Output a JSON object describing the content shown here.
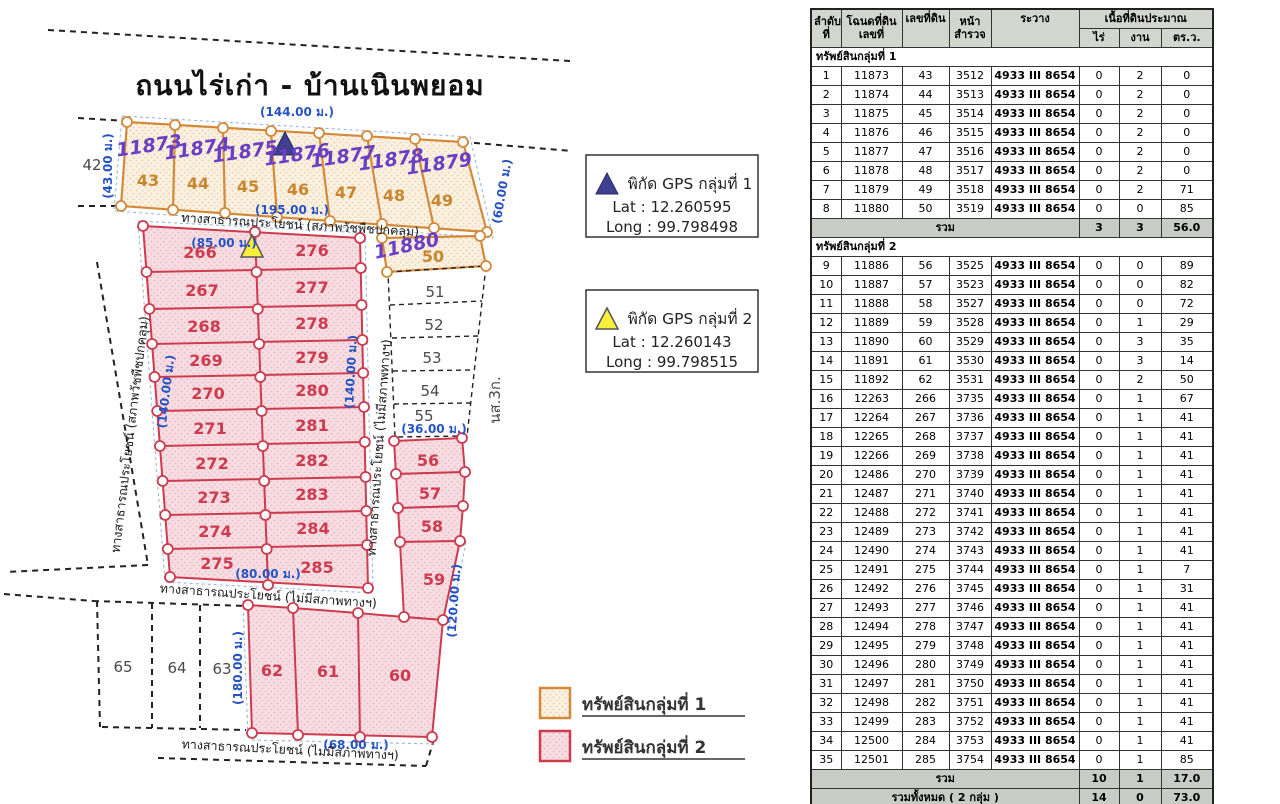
{
  "map": {
    "title": "ถนนไร่เก่า - บ้านเนินพยอม",
    "neighbor_left": "42",
    "ns3k": "นส.3ก.",
    "g1": {
      "deeds": [
        "11873",
        "11874",
        "11875",
        "11876",
        "11877",
        "11878",
        "11879"
      ],
      "nums": [
        "43",
        "44",
        "45",
        "46",
        "47",
        "48",
        "49"
      ],
      "dims": {
        "top": "(144.00 ม.)",
        "left": "(43.00 ม.)",
        "bottom": "(195.00 ม.)",
        "right": "(60.00 ม.)"
      }
    },
    "p50": {
      "deed": "11880",
      "num": "50"
    },
    "white_col": [
      "51",
      "52",
      "53",
      "54",
      "55"
    ],
    "white_col_dim": "(36.00 ม.)",
    "pink": {
      "left": [
        "266",
        "267",
        "268",
        "269",
        "270",
        "271",
        "272",
        "273",
        "274",
        "275"
      ],
      "right": [
        "276",
        "277",
        "278",
        "279",
        "280",
        "281",
        "282",
        "283",
        "284",
        "285"
      ],
      "dims": {
        "top": "(85.00 ม.)",
        "left": "(140.00 ม.)",
        "right": "(140.00 ม.)",
        "bottom": "(80.00 ม.)"
      }
    },
    "side": [
      "56",
      "57",
      "58",
      "59"
    ],
    "side_dim": "(120.00 ม.)",
    "bottom": {
      "nums": [
        "62",
        "61",
        "60"
      ],
      "dim_left": "(180.00 ม.)",
      "dim_bottom": "(68.00 ม.)"
    },
    "bottom_white": [
      "65",
      "64",
      "63"
    ],
    "roads": {
      "r1": "ทางสาธารณประโยชน์ (สภาพวัชพืชปกคลุม)",
      "r2": "ทางสาธารณประโยชน์ (สภาพวัชพืชปกคลุม)",
      "r3": "ทางสาธารณประโยชน์ (ไม่มีสภาพทางฯ)",
      "r4": "ทางสาธารณประโยชน์ (ไม่มีสภาพทางฯ)",
      "r5": "ทางสาธารณประโยชน์ (ไม่มีสภาพทางฯ)"
    },
    "colors": {
      "group1_accent": "#d4893a",
      "group2_accent": "#cc3b4e",
      "dim_blue": "#2653c4",
      "handwriting_purple": "#6b3fc4"
    }
  },
  "gps": {
    "g1": {
      "title": "พิกัด GPS  กลุ่มที่ 1",
      "lat": "Lat : 12.260595",
      "long": "Long : 99.798498",
      "marker": "navy-triangle"
    },
    "g2": {
      "title": "พิกัด GPS  กลุ่มที่ 2",
      "lat": "Lat : 12.260143",
      "long": "Long : 99.798515",
      "marker": "yellow-triangle"
    }
  },
  "legend": {
    "g1": "ทรัพย์สินกลุ่มที่ 1",
    "g2": "ทรัพย์สินกลุ่มที่ 2"
  },
  "table": {
    "headers": {
      "no1": "ลำดับ",
      "no2": "ที่",
      "deed1": "โฉนดที่ดิน",
      "deed2": "เลขที่",
      "land": "เลขที่ดิน",
      "page1": "หน้า",
      "page2": "สำรวจ",
      "sheet": "ระวาง",
      "area": "เนื้อที่ดินประมาณ",
      "rai": "ไร่",
      "ngan": "งาน",
      "wah": "ตร.ว."
    },
    "sections": [
      {
        "title": "ทรัพย์สินกลุ่มที่ 1",
        "rows": [
          [
            "1",
            "11873",
            "43",
            "3512",
            "4933 III 8654",
            "0",
            "2",
            "0"
          ],
          [
            "2",
            "11874",
            "44",
            "3513",
            "4933 III 8654",
            "0",
            "2",
            "0"
          ],
          [
            "3",
            "11875",
            "45",
            "3514",
            "4933 III 8654",
            "0",
            "2",
            "0"
          ],
          [
            "4",
            "11876",
            "46",
            "3515",
            "4933 III 8654",
            "0",
            "2",
            "0"
          ],
          [
            "5",
            "11877",
            "47",
            "3516",
            "4933 III 8654",
            "0",
            "2",
            "0"
          ],
          [
            "6",
            "11878",
            "48",
            "3517",
            "4933 III 8654",
            "0",
            "2",
            "0"
          ],
          [
            "7",
            "11879",
            "49",
            "3518",
            "4933 III 8654",
            "0",
            "2",
            "71"
          ],
          [
            "8",
            "11880",
            "50",
            "3519",
            "4933 III 8654",
            "0",
            "0",
            "85"
          ]
        ],
        "total": {
          "label": "รวม",
          "rai": "3",
          "ngan": "3",
          "wah": "56.0"
        }
      },
      {
        "title": "ทรัพย์สินกลุ่มที่ 2",
        "rows": [
          [
            "9",
            "11886",
            "56",
            "3525",
            "4933 III 8654",
            "0",
            "0",
            "89"
          ],
          [
            "10",
            "11887",
            "57",
            "3523",
            "4933 III 8654",
            "0",
            "0",
            "82"
          ],
          [
            "11",
            "11888",
            "58",
            "3527",
            "4933 III 8654",
            "0",
            "0",
            "72"
          ],
          [
            "12",
            "11889",
            "59",
            "3528",
            "4933 III 8654",
            "0",
            "1",
            "29"
          ],
          [
            "13",
            "11890",
            "60",
            "3529",
            "4933 III 8654",
            "0",
            "3",
            "35"
          ],
          [
            "14",
            "11891",
            "61",
            "3530",
            "4933 III 8654",
            "0",
            "3",
            "14"
          ],
          [
            "15",
            "11892",
            "62",
            "3531",
            "4933 III 8654",
            "0",
            "2",
            "50"
          ],
          [
            "16",
            "12263",
            "266",
            "3735",
            "4933 III 8654",
            "0",
            "1",
            "67"
          ],
          [
            "17",
            "12264",
            "267",
            "3736",
            "4933 III 8654",
            "0",
            "1",
            "41"
          ],
          [
            "18",
            "12265",
            "268",
            "3737",
            "4933 III 8654",
            "0",
            "1",
            "41"
          ],
          [
            "19",
            "12266",
            "269",
            "3738",
            "4933 III 8654",
            "0",
            "1",
            "41"
          ],
          [
            "20",
            "12486",
            "270",
            "3739",
            "4933 III 8654",
            "0",
            "1",
            "41"
          ],
          [
            "21",
            "12487",
            "271",
            "3740",
            "4933 III 8654",
            "0",
            "1",
            "41"
          ],
          [
            "22",
            "12488",
            "272",
            "3741",
            "4933 III 8654",
            "0",
            "1",
            "41"
          ],
          [
            "23",
            "12489",
            "273",
            "3742",
            "4933 III 8654",
            "0",
            "1",
            "41"
          ],
          [
            "24",
            "12490",
            "274",
            "3743",
            "4933 III 8654",
            "0",
            "1",
            "41"
          ],
          [
            "25",
            "12491",
            "275",
            "3744",
            "4933 III 8654",
            "0",
            "1",
            "7"
          ],
          [
            "26",
            "12492",
            "276",
            "3745",
            "4933 III 8654",
            "0",
            "1",
            "31"
          ],
          [
            "27",
            "12493",
            "277",
            "3746",
            "4933 III 8654",
            "0",
            "1",
            "41"
          ],
          [
            "28",
            "12494",
            "278",
            "3747",
            "4933 III 8654",
            "0",
            "1",
            "41"
          ],
          [
            "29",
            "12495",
            "279",
            "3748",
            "4933 III 8654",
            "0",
            "1",
            "41"
          ],
          [
            "30",
            "12496",
            "280",
            "3749",
            "4933 III 8654",
            "0",
            "1",
            "41"
          ],
          [
            "31",
            "12497",
            "281",
            "3750",
            "4933 III 8654",
            "0",
            "1",
            "41"
          ],
          [
            "32",
            "12498",
            "282",
            "3751",
            "4933 III 8654",
            "0",
            "1",
            "41"
          ],
          [
            "33",
            "12499",
            "283",
            "3752",
            "4933 III 8654",
            "0",
            "1",
            "41"
          ],
          [
            "34",
            "12500",
            "284",
            "3753",
            "4933 III 8654",
            "0",
            "1",
            "41"
          ],
          [
            "35",
            "12501",
            "285",
            "3754",
            "4933 III 8654",
            "0",
            "1",
            "85"
          ]
        ],
        "total": {
          "label": "รวม",
          "rai": "10",
          "ngan": "1",
          "wah": "17.0"
        }
      }
    ],
    "grand": {
      "label": "รวมทั้งหมด  ( 2 กลุ่ม )",
      "rai": "14",
      "ngan": "0",
      "wah": "73.0"
    }
  }
}
